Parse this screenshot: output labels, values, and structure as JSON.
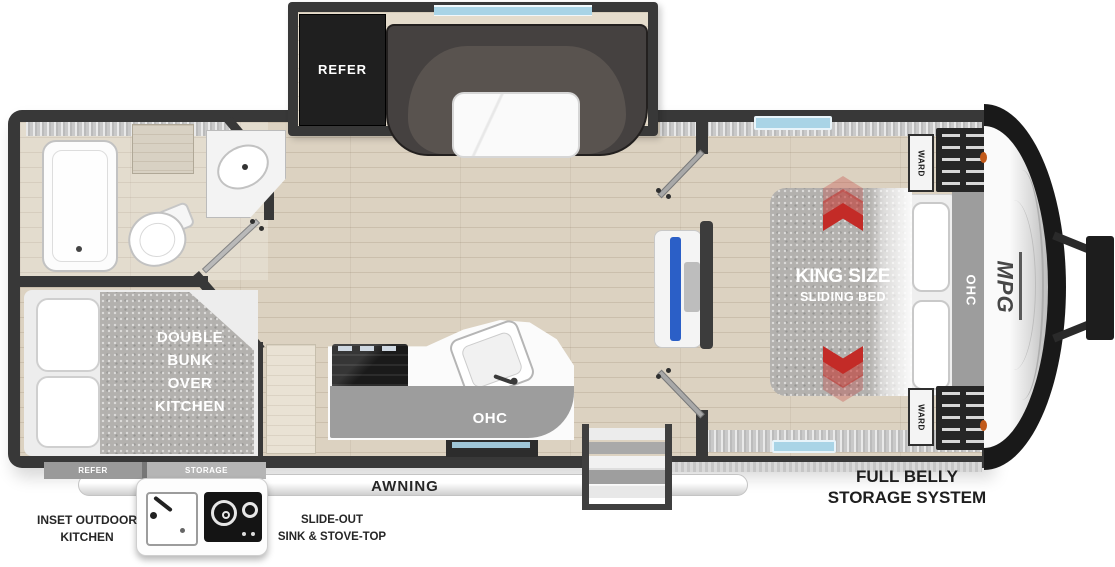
{
  "meta": {
    "title": "MPG Travel Trailer Floor Plan",
    "diagram_type": "rv-floorplan"
  },
  "labels": {
    "refer_slide": "REFER",
    "bunk_lines": [
      "DOUBLE",
      "BUNK",
      "OVER",
      "KITCHEN"
    ],
    "kitchen_ohc": "OHC",
    "awning": "AWNING",
    "bed_title": "KING SIZE",
    "bed_subtitle": "SLIDING BED",
    "ward_top": "WARD",
    "ward_bottom": "WARD",
    "bed_ohc": "OHC",
    "brand_logo": "MPG",
    "belly_lines": [
      "FULL BELLY",
      "STORAGE SYSTEM"
    ],
    "underbody_refer": "REFER",
    "underbody_storage": "STORAGE",
    "outdoor_kitchen_lines": [
      "INSET OUTDOOR",
      "KITCHEN"
    ],
    "slideout_kitchen_lines": [
      "SLIDE-OUT",
      "SINK & STOVE-TOP"
    ]
  },
  "colors": {
    "wall": "#383838",
    "floor_wood": "#dcd2c1",
    "cabinet_gray": "#9d9d9d",
    "mattress_gray": "#b3b1ae",
    "arrow_red": "#c32b27",
    "window_blue": "#a9d4e6",
    "tv_blue": "#2b5fc7",
    "marker_orange": "#c25a1a",
    "refer_dark": "#1f1f1f",
    "sofa_dark": "#454140"
  }
}
